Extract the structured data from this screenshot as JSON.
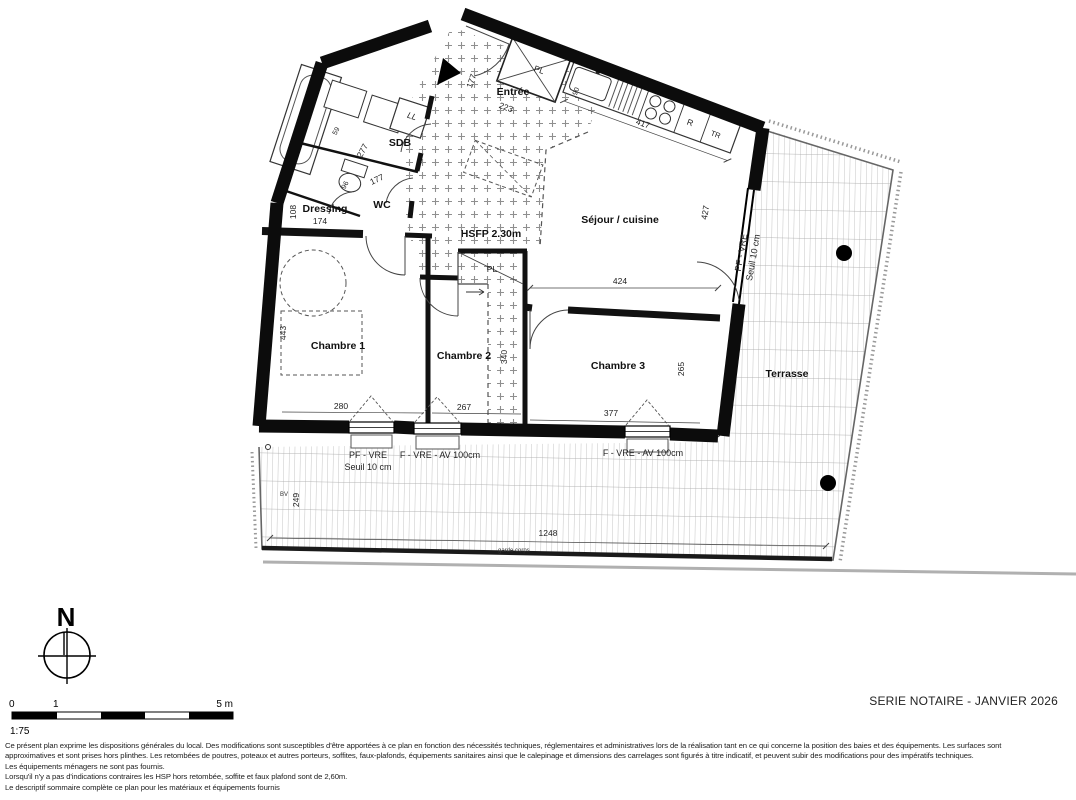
{
  "doc": {
    "series_label": "SERIE NOTAIRE - JANVIER 2026",
    "scale_ratio": "1:75",
    "scale_tick_0": "0",
    "scale_tick_1": "1",
    "scale_tick_5": "5 m",
    "north_label": "N",
    "disclaimer_lines": [
      "Ce présent plan exprime les dispositions générales du local. Des modifications sont susceptibles d'être apportées à ce plan en fonction des nécessités techniques, réglementaires et administratives lors de la réalisation tant en ce qui concerne la position des baies et des équipements. Les surfaces sont",
      "approximatives et sont prises hors plinthes. Les retombées de poutres, poteaux et autres porteurs, soffites, faux-plafonds, équipements sanitaires ainsi que le calepinage et dimensions des carrelages sont figurés à titre indicatif, et peuvent subir des modifications pour des impératifs techniques.",
      "Les équipements ménagers ne sont pas fournis.",
      "Lorsqu'il n'y a pas d'indications contraires les HSP hors retombée, soffite et faux plafond sont de 2,60m.",
      "Le descriptif sommaire complète ce plan pour les matériaux et équipements fournis"
    ]
  },
  "rooms": {
    "entree": "Entrée",
    "sdb": "SDB",
    "wc": "WC",
    "dressing": "Dressing",
    "sejour": "Séjour / cuisine",
    "chambre1": "Chambre 1",
    "chambre2": "Chambre 2",
    "chambre3": "Chambre 3",
    "terrasse": "Terrasse"
  },
  "annotations": {
    "hsfp": "HSFP 2.30m",
    "pl_entree": "PL",
    "pl_hall": "PL",
    "washer": "LL",
    "fridge": "R",
    "tr": "TR",
    "bv": "BV",
    "garde_corps": "garde corps"
  },
  "openings": {
    "pf_vre": "PF - VRE",
    "seuil": "Seuil 10 cm",
    "f_vre_av_1": "F - VRE - AV 100cm",
    "f_vre_av_2": "F - VRE - AV 100cm",
    "pf_vre_right_1": "PF - VRE",
    "pf_vre_right_2": "Seuil 10 cm"
  },
  "dimensions": {
    "entree_w": "177",
    "entree_l": "223",
    "kitchen": "417",
    "sejour_h": "427",
    "ch3_top": "424",
    "ch1_h": "443",
    "ch1_w": "280",
    "ch2_w": "267",
    "ch2_h": "340",
    "ch3_w": "377",
    "ch3_h": "265",
    "dressing_w": "174",
    "dressing_h": "108",
    "sdb_w": "277",
    "wc_w": "177",
    "wc_d": "96",
    "tub": "59",
    "sink": "90",
    "terrace_w": "1248",
    "terrace_h": "249"
  },
  "colors": {
    "wall": "#0c0c0c",
    "hatch": "#8f8f8f",
    "terrace_line": "#b5b5b5",
    "dashed": "#555555"
  }
}
